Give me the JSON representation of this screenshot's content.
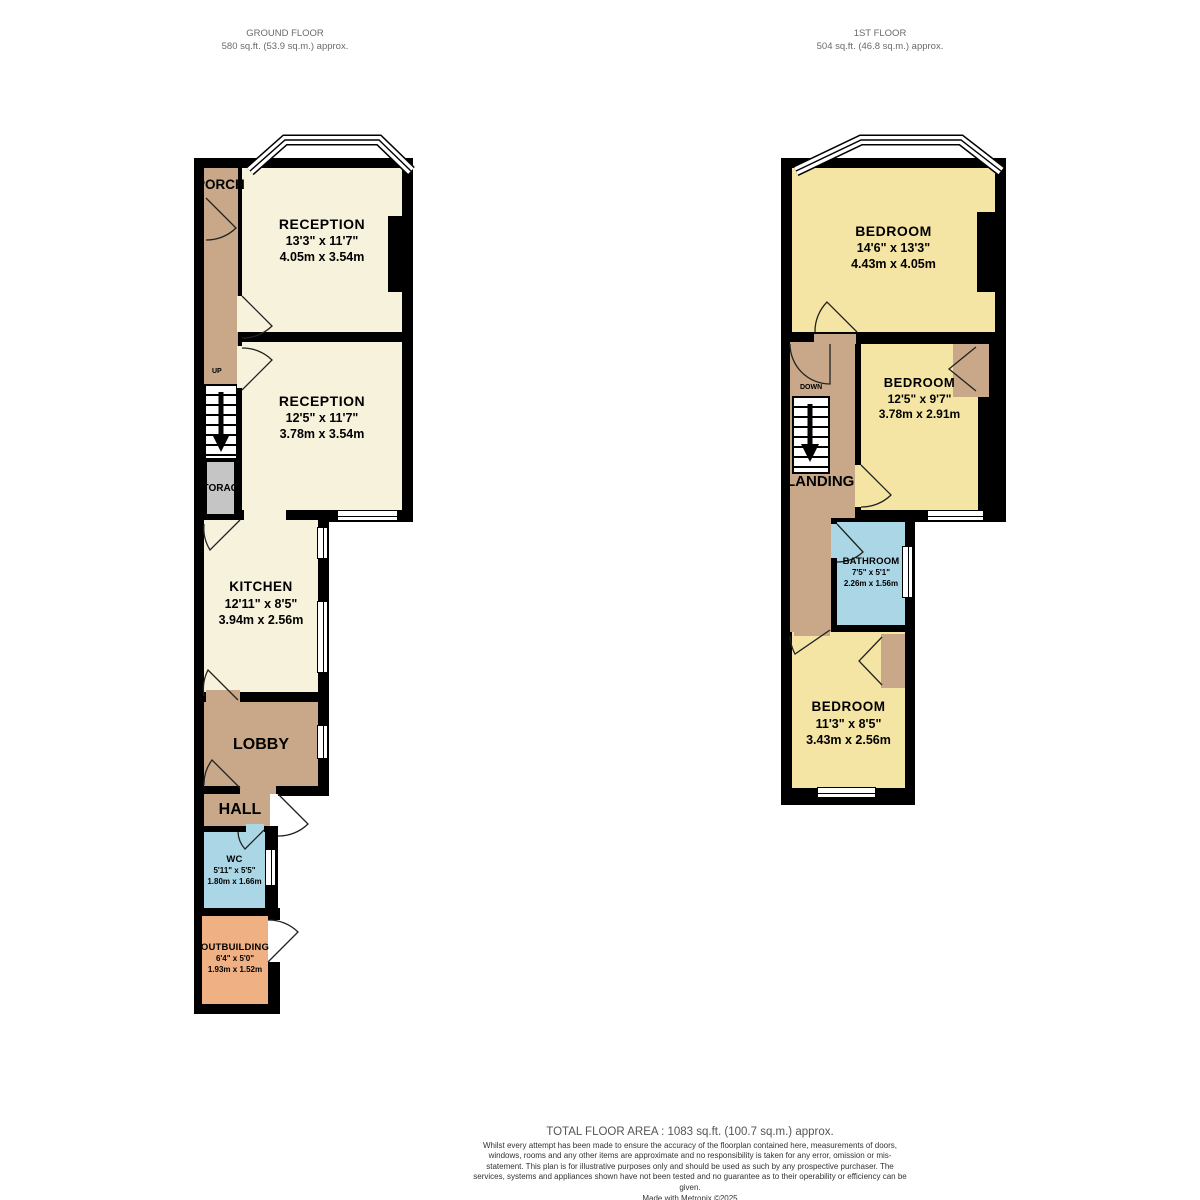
{
  "headers": {
    "ground": {
      "title": "GROUND FLOOR",
      "area": "580 sq.ft. (53.9 sq.m.) approx."
    },
    "first": {
      "title": "1ST FLOOR",
      "area": "504 sq.ft. (46.8 sq.m.) approx."
    }
  },
  "ground_rooms": {
    "porch": {
      "name": "PORCH"
    },
    "reception1": {
      "name": "RECEPTION",
      "imperial": "13'3\" x 11'7\"",
      "metric": "4.05m x 3.54m"
    },
    "reception2": {
      "name": "RECEPTION",
      "imperial": "12'5\" x 11'7\"",
      "metric": "3.78m x 3.54m"
    },
    "storage": {
      "name": "STORAGE"
    },
    "kitchen": {
      "name": "KITCHEN",
      "imperial": "12'11\" x 8'5\"",
      "metric": "3.94m x 2.56m"
    },
    "lobby": {
      "name": "LOBBY"
    },
    "hall": {
      "name": "HALL"
    },
    "wc": {
      "name": "WC",
      "imperial": "5'11\" x 5'5\"",
      "metric": "1.80m x 1.66m"
    },
    "outbuilding": {
      "name": "OUTBUILDING",
      "imperial": "6'4\" x 5'0\"",
      "metric": "1.93m x 1.52m"
    },
    "up_label": "UP"
  },
  "first_rooms": {
    "bedroom1": {
      "name": "BEDROOM",
      "imperial": "14'6\" x 13'3\"",
      "metric": "4.43m x 4.05m"
    },
    "bedroom2": {
      "name": "BEDROOM",
      "imperial": "12'5\" x 9'7\"",
      "metric": "3.78m x 2.91m"
    },
    "landing": {
      "name": "LANDING"
    },
    "bathroom": {
      "name": "BATHROOM",
      "imperial": "7'5\" x 5'1\"",
      "metric": "2.26m x 1.56m"
    },
    "bedroom3": {
      "name": "BEDROOM",
      "imperial": "11'3\" x 8'5\"",
      "metric": "3.43m x 2.56m"
    },
    "down_label": "DOWN"
  },
  "footer": {
    "total": "TOTAL FLOOR AREA : 1083 sq.ft. (100.7 sq.m.) approx.",
    "disclaimer": "Whilst every attempt has been made to ensure the accuracy of the floorplan contained here, measurements of doors, windows, rooms and any other items are approximate and no responsibility is taken for any error, omission or mis-statement. This plan is for illustrative purposes only and should be used as such by any prospective purchaser. The services, systems and appliances shown have not been tested and no guarantee as to their operability or efficiency can be given.",
    "credit": "Made with Metropix ©2025"
  },
  "colors": {
    "wall": "#000000",
    "reception": "#F7F2DC",
    "bedroom": "#F5E5A4",
    "hallway": "#C8A888",
    "bathroom": "#ABD6E5",
    "outbuilding": "#EFB083",
    "storage": "#C6C5C6"
  }
}
